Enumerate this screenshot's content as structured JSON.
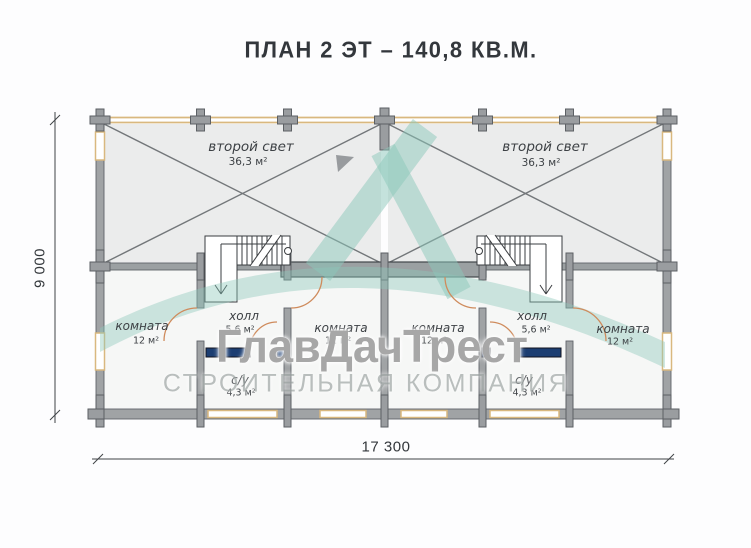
{
  "title": "ПЛАН 2 ЭТ – 140,8 КВ.М.",
  "watermark": {
    "brand": "ГлавДачТрест",
    "subtitle": "СТРОИТЕЛЬНАЯ КОМПАНИЯ"
  },
  "dimensions": {
    "height_mm": "9 000",
    "width_mm": "17 300"
  },
  "rooms": {
    "second_light_left": {
      "name": "второй свет",
      "area": "36,3 м²"
    },
    "second_light_right": {
      "name": "второй свет",
      "area": "36,3 м²"
    },
    "room_left": {
      "name": "комната",
      "area": "12 м²"
    },
    "hall_left": {
      "name": "холл",
      "area": "5,6 м²"
    },
    "wc_left": {
      "name": "с/у",
      "area": "4,3 м²"
    },
    "room_center_left": {
      "name": "комната",
      "area": "12 м²"
    },
    "room_center_right": {
      "name": "комната",
      "area": "12 м²"
    },
    "hall_right": {
      "name": "холл",
      "area": "5,6 м²"
    },
    "wc_right": {
      "name": "с/у",
      "area": "4,3 м²"
    },
    "room_right": {
      "name": "комната",
      "area": "12 м²"
    }
  },
  "colors": {
    "wall_gray": "#a0a3a5",
    "wall_outline": "#60646a",
    "timber_tan": "#d9b87f",
    "floor_upper": "#ebecec",
    "floor_lower": "#f6f7f6",
    "diagonal_line": "#73777a",
    "navy_window": "#1c3e72",
    "door_arc": "#cf8b5c",
    "logo_teal": "#8cc7ba",
    "text_dark": "#33373c"
  }
}
